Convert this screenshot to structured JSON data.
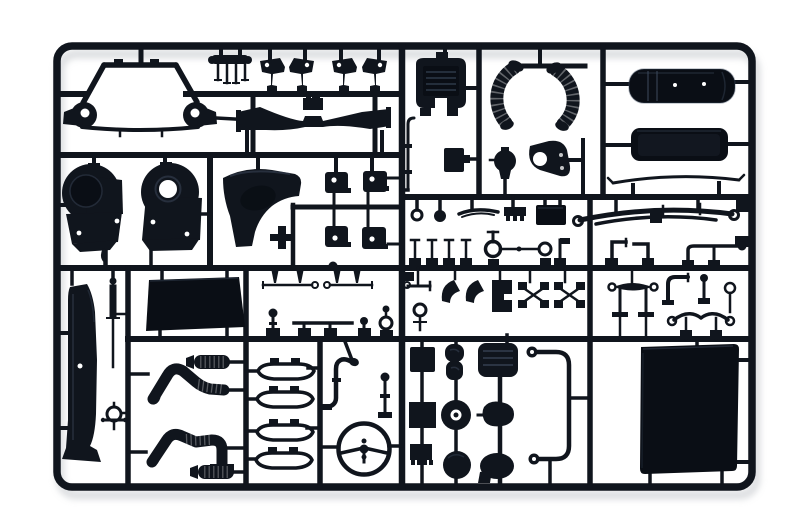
{
  "scene": {
    "type": "product-photo",
    "object": "injection-moulded model kit sprue (parts tree)",
    "material": "black styrene plastic",
    "background": "plain white studio background",
    "description": "Black plastic model-kit sprue photographed on white: a rounded rectangular runner frame with an internal grid of runners carrying truck-model parts — cab subframe, gearbox housings, fender, corrugated intake hoses, fuel tanks, leaf springs, exhaust pipes, mufflers, step boards, steering wheel, roof panel and many small fittings."
  },
  "colors": {
    "background": "#ffffff",
    "plastic": "#10151d",
    "deep": "#0a0e15",
    "sheen": "#3d4a5e",
    "shadow": "#bcc0c5"
  },
  "parts": [
    {
      "id": "sprue-frame",
      "label": "outer runner frame"
    },
    {
      "id": "cab-subframe",
      "label": "cab sub-frame with bearing eyes"
    },
    {
      "id": "seat-bracket",
      "label": "small four-leg bracket"
    },
    {
      "id": "mudflap-brackets",
      "label": "two mirrored mud-flap bracket pairs"
    },
    {
      "id": "front-axle-beam",
      "label": "wide gull-wing axle beam"
    },
    {
      "id": "gearbox-housing-left",
      "label": "round gearbox housing (closed)"
    },
    {
      "id": "gearbox-housing-right",
      "label": "round gearbox housing (open bore)"
    },
    {
      "id": "front-fender",
      "label": "front fender quarter panel"
    },
    {
      "id": "mount-brackets",
      "label": "four square body-mount brackets"
    },
    {
      "id": "air-intake-box",
      "label": "ribbed air intake box"
    },
    {
      "id": "intake-hose-left",
      "label": "corrugated intake hose (left)"
    },
    {
      "id": "intake-hose-right",
      "label": "corrugated intake hose (right)"
    },
    {
      "id": "fuel-tank-main",
      "label": "large strapped fuel tank"
    },
    {
      "id": "fuel-tank-aux",
      "label": "auxiliary fuel tank"
    },
    {
      "id": "visor-blade",
      "label": "thin curved visor blade"
    },
    {
      "id": "leaf-spring",
      "label": "leaf spring with eye ends"
    },
    {
      "id": "hardware-row-a",
      "label": "row of small fittings: ring pin, ball pin, wiper arm, ribbed plate, battery box"
    },
    {
      "id": "hardware-row-b",
      "label": "row of pins, tow-ring link, brackets and gear lever"
    },
    {
      "id": "hardware-row-c",
      "label": "linkages, brake shoes, torque-rod axle, stabilizer links"
    },
    {
      "id": "hardware-row-mid",
      "label": "tie rods, pins and ring fittings"
    },
    {
      "id": "side-deflector",
      "label": "tall air-deflector blade panel"
    },
    {
      "id": "antenna-rod",
      "label": "threaded antenna rod"
    },
    {
      "id": "drag-link-ring",
      "label": "small ring with cross arms"
    },
    {
      "id": "floor-panel",
      "label": "large flat floor panel"
    },
    {
      "id": "exhaust-pipe-upper",
      "label": "curved exhaust down-pipe (upper)"
    },
    {
      "id": "exhaust-pipe-lower",
      "label": "curved exhaust down-pipe (lower)"
    },
    {
      "id": "muffler-upper",
      "label": "ribbed muffler (upper)"
    },
    {
      "id": "muffler-lower",
      "label": "ribbed muffler (lower)"
    },
    {
      "id": "step-boards",
      "label": "four outlined step boards"
    },
    {
      "id": "stack-elbow",
      "label": "exhaust stack elbow"
    },
    {
      "id": "shift-lever",
      "label": "shift lever rod"
    },
    {
      "id": "steering-wheel",
      "label": "three-spoke steering wheel"
    },
    {
      "id": "storage-box",
      "label": "storage box"
    },
    {
      "id": "seat-back",
      "label": "seat cushion pair"
    },
    {
      "id": "intake-grille",
      "label": "slatted intake grille"
    },
    {
      "id": "mount-block",
      "label": "square mount block"
    },
    {
      "id": "pulley-wheel",
      "label": "pulley wheel with hub"
    },
    {
      "id": "air-horn",
      "label": "air horn body"
    },
    {
      "id": "brake-drum",
      "label": "brake drum disc"
    },
    {
      "id": "horn-bell",
      "label": "horn bell oval"
    },
    {
      "id": "comb-bracket",
      "label": "toothed connector bracket"
    },
    {
      "id": "tilt-tube",
      "label": "large cab-tilt tube bracket"
    },
    {
      "id": "roof-panel",
      "label": "large cab roof panel"
    },
    {
      "id": "relay-plate",
      "label": "small rectangular plate"
    },
    {
      "id": "horn-button",
      "label": "round knob"
    },
    {
      "id": "engine-bracket",
      "label": "engine bracket with bore"
    },
    {
      "id": "thin-pipe",
      "label": "thin hooked pipe"
    }
  ]
}
